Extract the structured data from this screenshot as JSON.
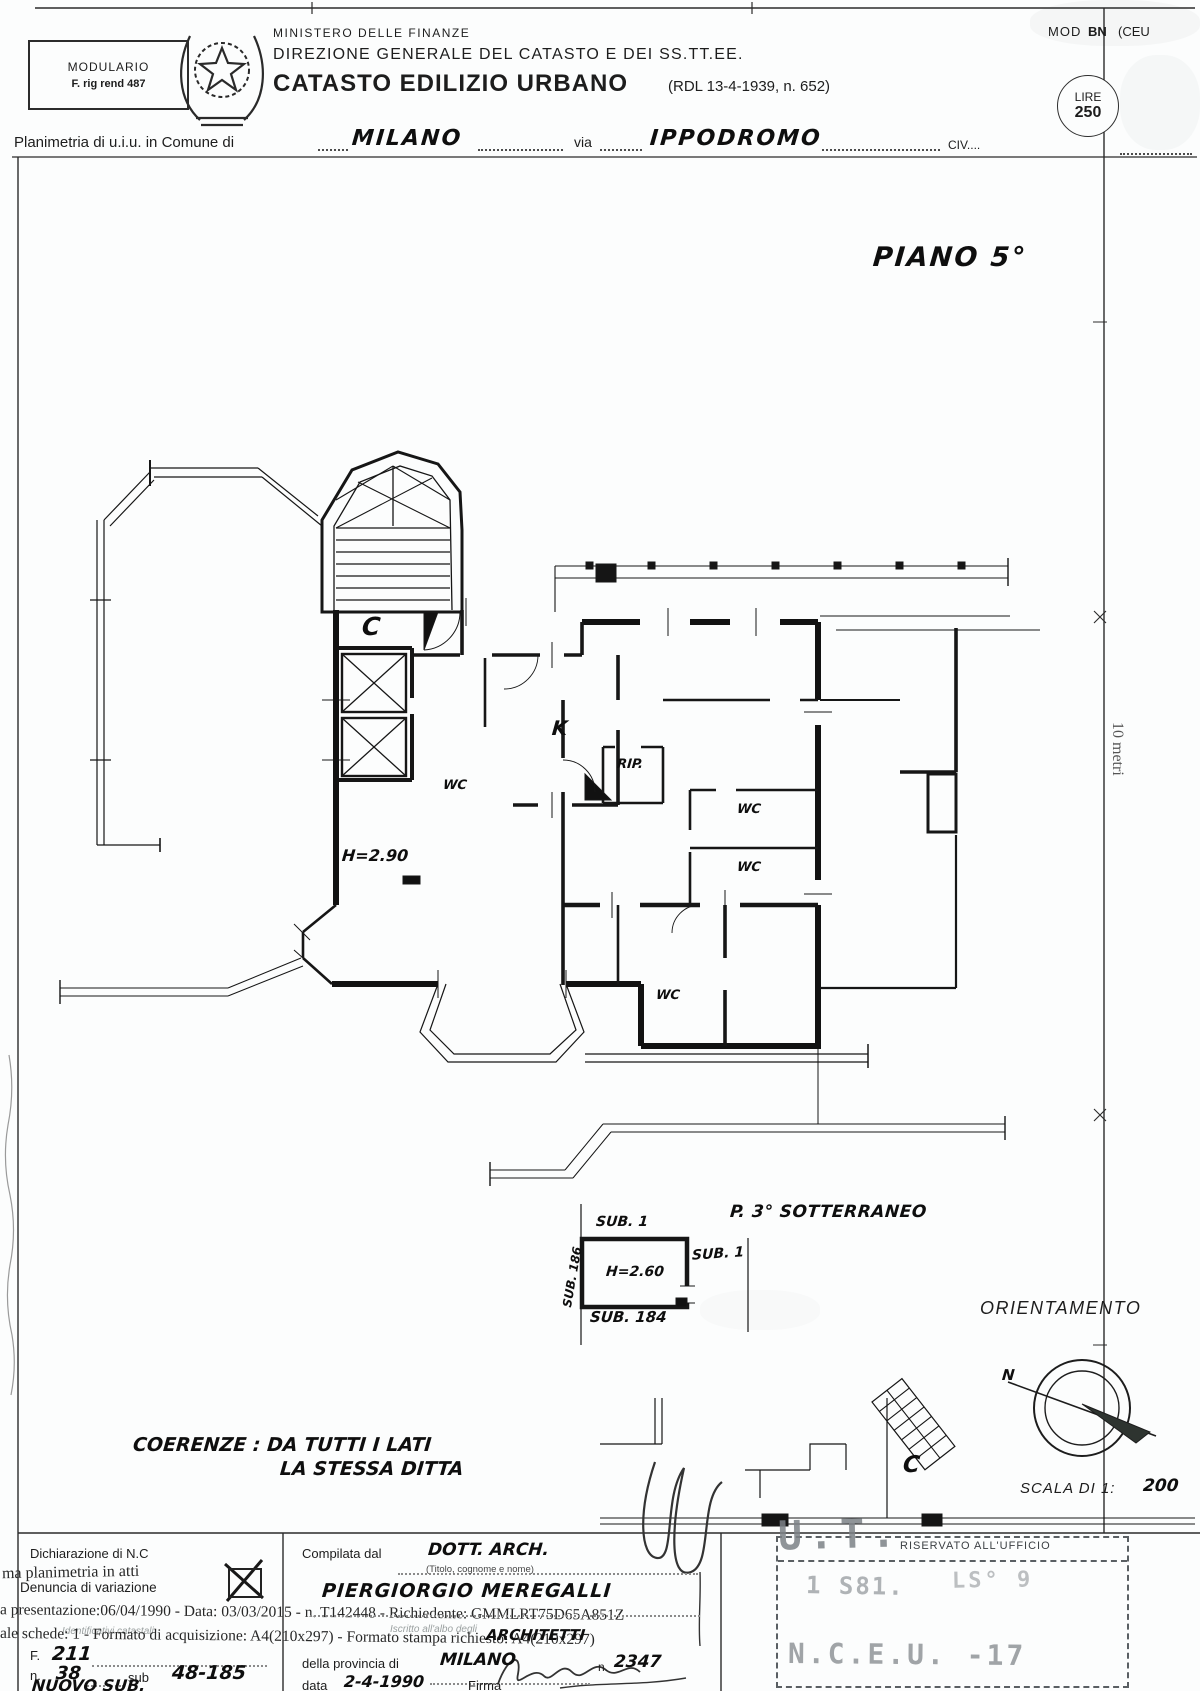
{
  "header": {
    "modulario": {
      "line1": "MODULARIO",
      "line2": "F. rig rend 487"
    },
    "ministry_top": "MINISTERO DELLE FINANZE",
    "ministry_sub": "DIREZIONE GENERALE DEL CATASTO E DEI SS.TT.EE.",
    "title": "CATASTO EDILIZIO URBANO",
    "title_ref": "(RDL 13-4-1939, n. 652)",
    "mod_label": "MOD",
    "mod_code": "BN",
    "mod_paren": "(CEU",
    "stamp_currency": "LIRE",
    "stamp_value": "250",
    "row_label": "Planimetria di u.i.u. in Comune di",
    "comune": "MILANO",
    "via_label": "via",
    "via_value": "IPPODROMO",
    "civ_label": "CIV...."
  },
  "plan": {
    "floor": "PIANO 5°",
    "stair_c": "C",
    "kitchen": "K",
    "storage": "RIP.",
    "wc": [
      "WC",
      "WC",
      "WC",
      "WC"
    ],
    "height": "H=2.90",
    "scale_bar": "10 metri"
  },
  "basement": {
    "title": "P. 3° SOTTERRANEO",
    "sub_top": "SUB. 1",
    "sub_right": "SUB. 1",
    "sub_left": "SUB. 186",
    "sub_bottom": "SUB. 184",
    "height": "H=2.60",
    "stair_c": "C"
  },
  "orientation": {
    "title": "ORIENTAMENTO",
    "north": "N"
  },
  "scale_note": {
    "label": "SCALA DI 1:",
    "value": "200"
  },
  "coerenze": {
    "line1": "COERENZE : DA TUTTI I LATI",
    "line2": "LA STESSA DITTA"
  },
  "form": {
    "left": {
      "dichiarazione": "Dichiarazione di N.C",
      "overlay_atti": "ma planimetria in atti",
      "denuncia": "Denuncia di variazione",
      "overlay_row1": "a presentazione:06/04/1990 - Data: 03/03/2015 - n. T142448 - Richiedente: GMMLRT75D65A851Z",
      "overlay_row2": "ale schede: 1 - Formato di acquisizione: A4(210x297) - Formato stampa richiesto: A4(210x297)",
      "faint_catastali": "Identificativi catastali",
      "f_label": "F.",
      "f_value": "211",
      "n_label": "n.",
      "n_value": "38",
      "sub_label": "sub",
      "sub_value": "48-185",
      "nuovo_sub": "NUOVO SUB."
    },
    "right": {
      "compilata_label": "Compilata dal",
      "compilata_value": "DOTT. ARCH.",
      "titolo_hint": "(Titolo, cognome e nome)",
      "name": "PIERGIORGIO MEREGALLI",
      "faint_albo": "Iscritto all'albo degli",
      "albo_value": "ARCHITETTI",
      "provincia_label": "della provincia di",
      "provincia_value": "MILANO",
      "n_label": "n.",
      "n_value": "2347",
      "data_label": "data",
      "data_value": "2-4-1990",
      "firma_label": "Firma"
    },
    "office": {
      "header": "RISERVATO ALL'UFFICIO",
      "ut": "U.T.",
      "stamp_a": "1 S81.",
      "stamp_b": "LS° 9",
      "stamp_nceu": "N.C.E.U. -17"
    }
  }
}
